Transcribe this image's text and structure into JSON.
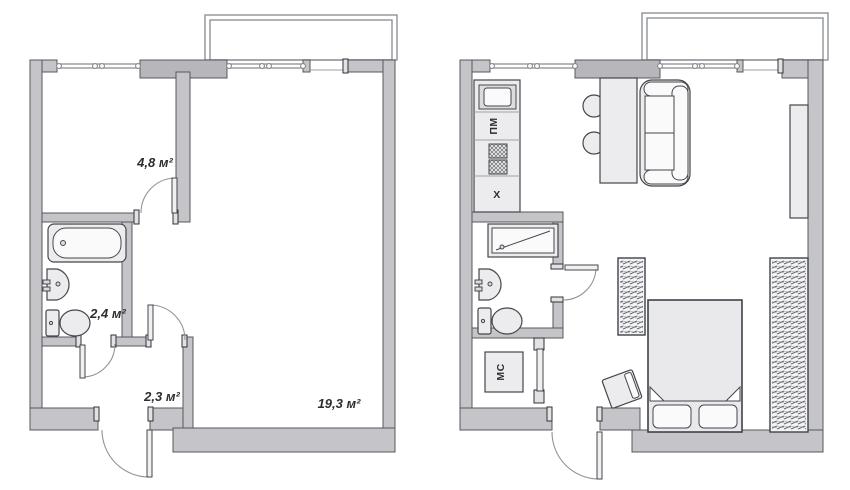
{
  "page": {
    "type": "apartment-floor-plan",
    "background": "#ffffff"
  },
  "colors": {
    "wall_fill": "#c5c5c9",
    "wall_outline": "#54585c",
    "furniture_fill": "#ececee",
    "furniture_outline": "#43474b",
    "door_arc": "#90949a",
    "label_text": "#2d2d2f"
  },
  "left_plan": {
    "name": "plan-before-empty",
    "rooms": [
      {
        "id": "small-room",
        "area_label": "4,8 м²"
      },
      {
        "id": "bathroom",
        "area_label": "2,4 м²"
      },
      {
        "id": "hallway",
        "area_label": "2,3 м²"
      },
      {
        "id": "living-room",
        "area_label": "19,3 м²"
      }
    ],
    "fixtures": [
      "bathtub",
      "wash-basin",
      "toilet"
    ]
  },
  "right_plan": {
    "name": "plan-after-furnished",
    "appliances": {
      "dishwasher_label": "ПМ",
      "fridge_label": "Х",
      "washing_machine_label": "МС"
    },
    "furniture": [
      "kitchen-sink",
      "stove",
      "dining-table",
      "chairs",
      "sofa",
      "shower",
      "wash-basin",
      "toilet",
      "washing-machine",
      "wardrobe",
      "wardrobe",
      "bed",
      "stool",
      "shelf"
    ]
  }
}
